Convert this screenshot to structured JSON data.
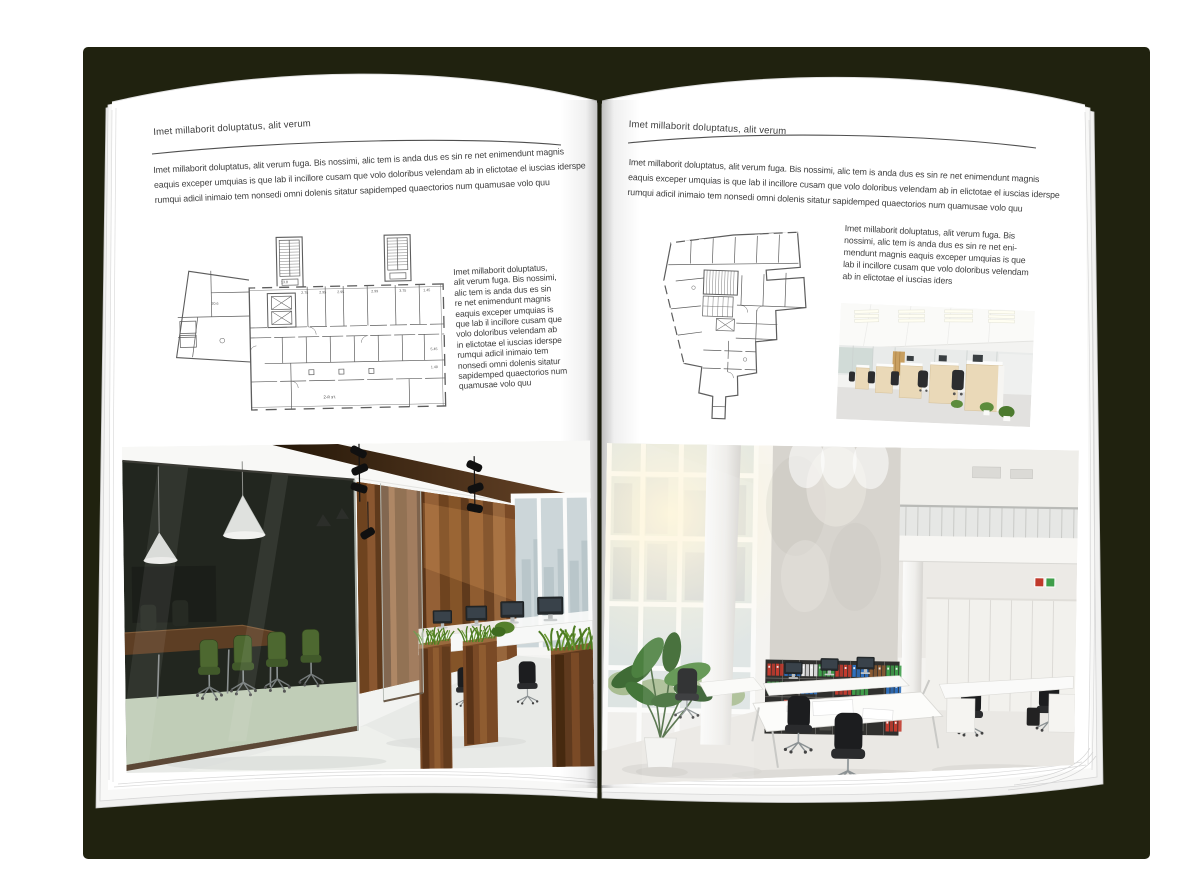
{
  "palette": {
    "backdrop": "#20220f",
    "page": "#ffffff",
    "text": "#3e3e3e",
    "rule": "#4f4f4f",
    "plan_line": "#5d5d5d",
    "wood_wall": "#8a5730",
    "meeting_room_glass": "#22261f",
    "chair_green": "#4d6830",
    "grass": "#4e7c23",
    "floor": "#e8eae7",
    "binder_red": "#c23b2e",
    "binder_blue": "#2e6fbd",
    "binder_green": "#3f9e4a"
  },
  "left_page": {
    "header": "Imet millaborit doluptatus, alit verum",
    "intro_lines": [
      "Imet millaborit doluptatus, alit verum fuga. Bis nossimi, alic tem is anda dus es sin re net enimendunt magnis",
      "eaquis exceper umquias is que lab il incillore cusam que volo doloribus velendam ab in elictotae el iuscias iderspe",
      "rumqui adicil inimaio tem nonsedi omni dolenis sitatur sapidemped quaectorios num quamusae volo quu"
    ],
    "floorplan": {
      "floor_label": "2-й эт.",
      "dims": [
        "2.75",
        "2.95",
        "2.95",
        "2.99",
        "3.75",
        "1.45",
        "13.8",
        "20.6",
        "5.45",
        "1.40"
      ]
    },
    "side_text_lines": [
      "Imet millaborit doluptatus,",
      "alit verum fuga. Bis nossimi,",
      "alic tem is anda dus es sin",
      "re net enimendunt magnis",
      "eaquis exceper umquias is",
      "que lab il incillore cusam que",
      "volo doloribus velendam ab",
      "in elictotae el iuscias iderspe",
      "rumqui adicil inimaio tem",
      "nonsedi omni dolenis sitatur",
      "sapidemped quaectorios num",
      "quamusae volo quu"
    ]
  },
  "right_page": {
    "header": "Imet millaborit doluptatus, alit verum",
    "intro_lines": [
      "Imet millaborit doluptatus, alit verum fuga. Bis nossimi, alic tem is anda dus es sin re net enimendunt magnis",
      "eaquis exceper umquias is que lab il incillore cusam que volo doloribus velendam ab in elictotae el iuscias iderspe",
      "rumqui adicil inimaio tem nonsedi omni dolenis sitatur sapidemped quaectorios num quamusae volo quu"
    ],
    "side_text_lines": [
      "Imet millaborit doluptatus, alit verum fuga. Bis",
      "nossimi, alic tem is anda dus es sin re net eni-",
      "mendunt magnis eaquis exceper umquias is que",
      "lab il incillore cusam que volo doloribus velendam",
      "ab in elictotae el iuscias iders"
    ]
  }
}
